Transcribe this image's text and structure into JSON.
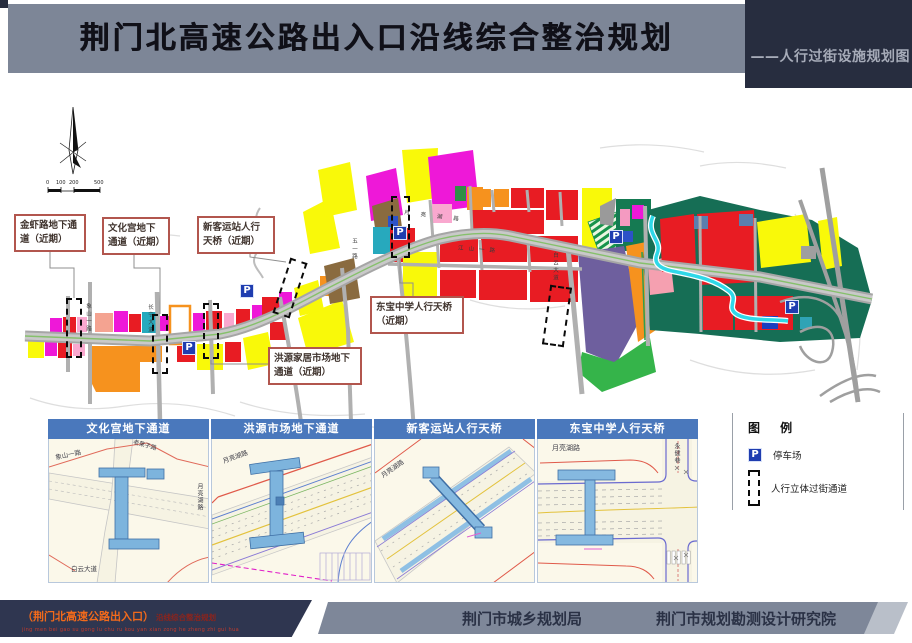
{
  "header": {
    "title": "荆门北高速公路出入口沿线综合整治规划",
    "subtitle": "——人行过街设施规划图"
  },
  "map": {
    "parking_icon": "P",
    "scale_labels": [
      "0",
      "100",
      "200",
      "500"
    ],
    "callouts": [
      {
        "label": "金虾路地下通道（近期）"
      },
      {
        "label": "文化宫地下通道（近期）"
      },
      {
        "label": "新客运站人行天桥（近期）"
      },
      {
        "label": "东宝中学人行天桥（近期）"
      },
      {
        "label": "洪源家居市场地下通道（近期）"
      }
    ],
    "road_labels": [
      "象山一路",
      "长宁大道",
      "月亮湖路",
      "江山一路",
      "白云大道",
      "五一路"
    ]
  },
  "panels": [
    {
      "title": "文化宫地下通道",
      "labels": [
        "象山一路",
        "老莱子路",
        "白云大道",
        "月亮湖路"
      ]
    },
    {
      "title": "洪源市场地下通道",
      "labels": [
        "月亮湖路"
      ]
    },
    {
      "title": "新客运站人行天桥",
      "labels": [
        "月亮湖路"
      ]
    },
    {
      "title": "东宝中学人行天桥",
      "labels": [
        "月亮湖路",
        "永健巷"
      ]
    }
  ],
  "legend": {
    "title": "图 例",
    "items": [
      {
        "icon": "parking-icon",
        "label": "停车场"
      },
      {
        "icon": "pedestrian-crossing-icon",
        "label": "人行立体过街通道"
      }
    ]
  },
  "footer": {
    "project_bracket": "（荆门北高速公路出入口）",
    "project_rest": "沿线综合整治规划",
    "pinyin": "jing men bei gao su gong lu chu ru kou yan xian  zong he zheng zhi gui hua",
    "org_left": "荆门市城乡规划局",
    "org_right": "荆门市规划勘测设计研究院"
  },
  "colors": {
    "header_gray": "#7d8697",
    "header_navy": "#272d3f",
    "panel_blue": "#4a78bc",
    "parking_blue": "#1f3db0",
    "callout_border": "#b2564e",
    "land_red": "#e81c23",
    "land_yellow": "#f9f909",
    "land_orange": "#f6921e",
    "land_magenta": "#ee18d8",
    "land_purple": "#6e5f9e",
    "land_teal": "#166e55",
    "river_cyan": "#2fd8e8"
  }
}
